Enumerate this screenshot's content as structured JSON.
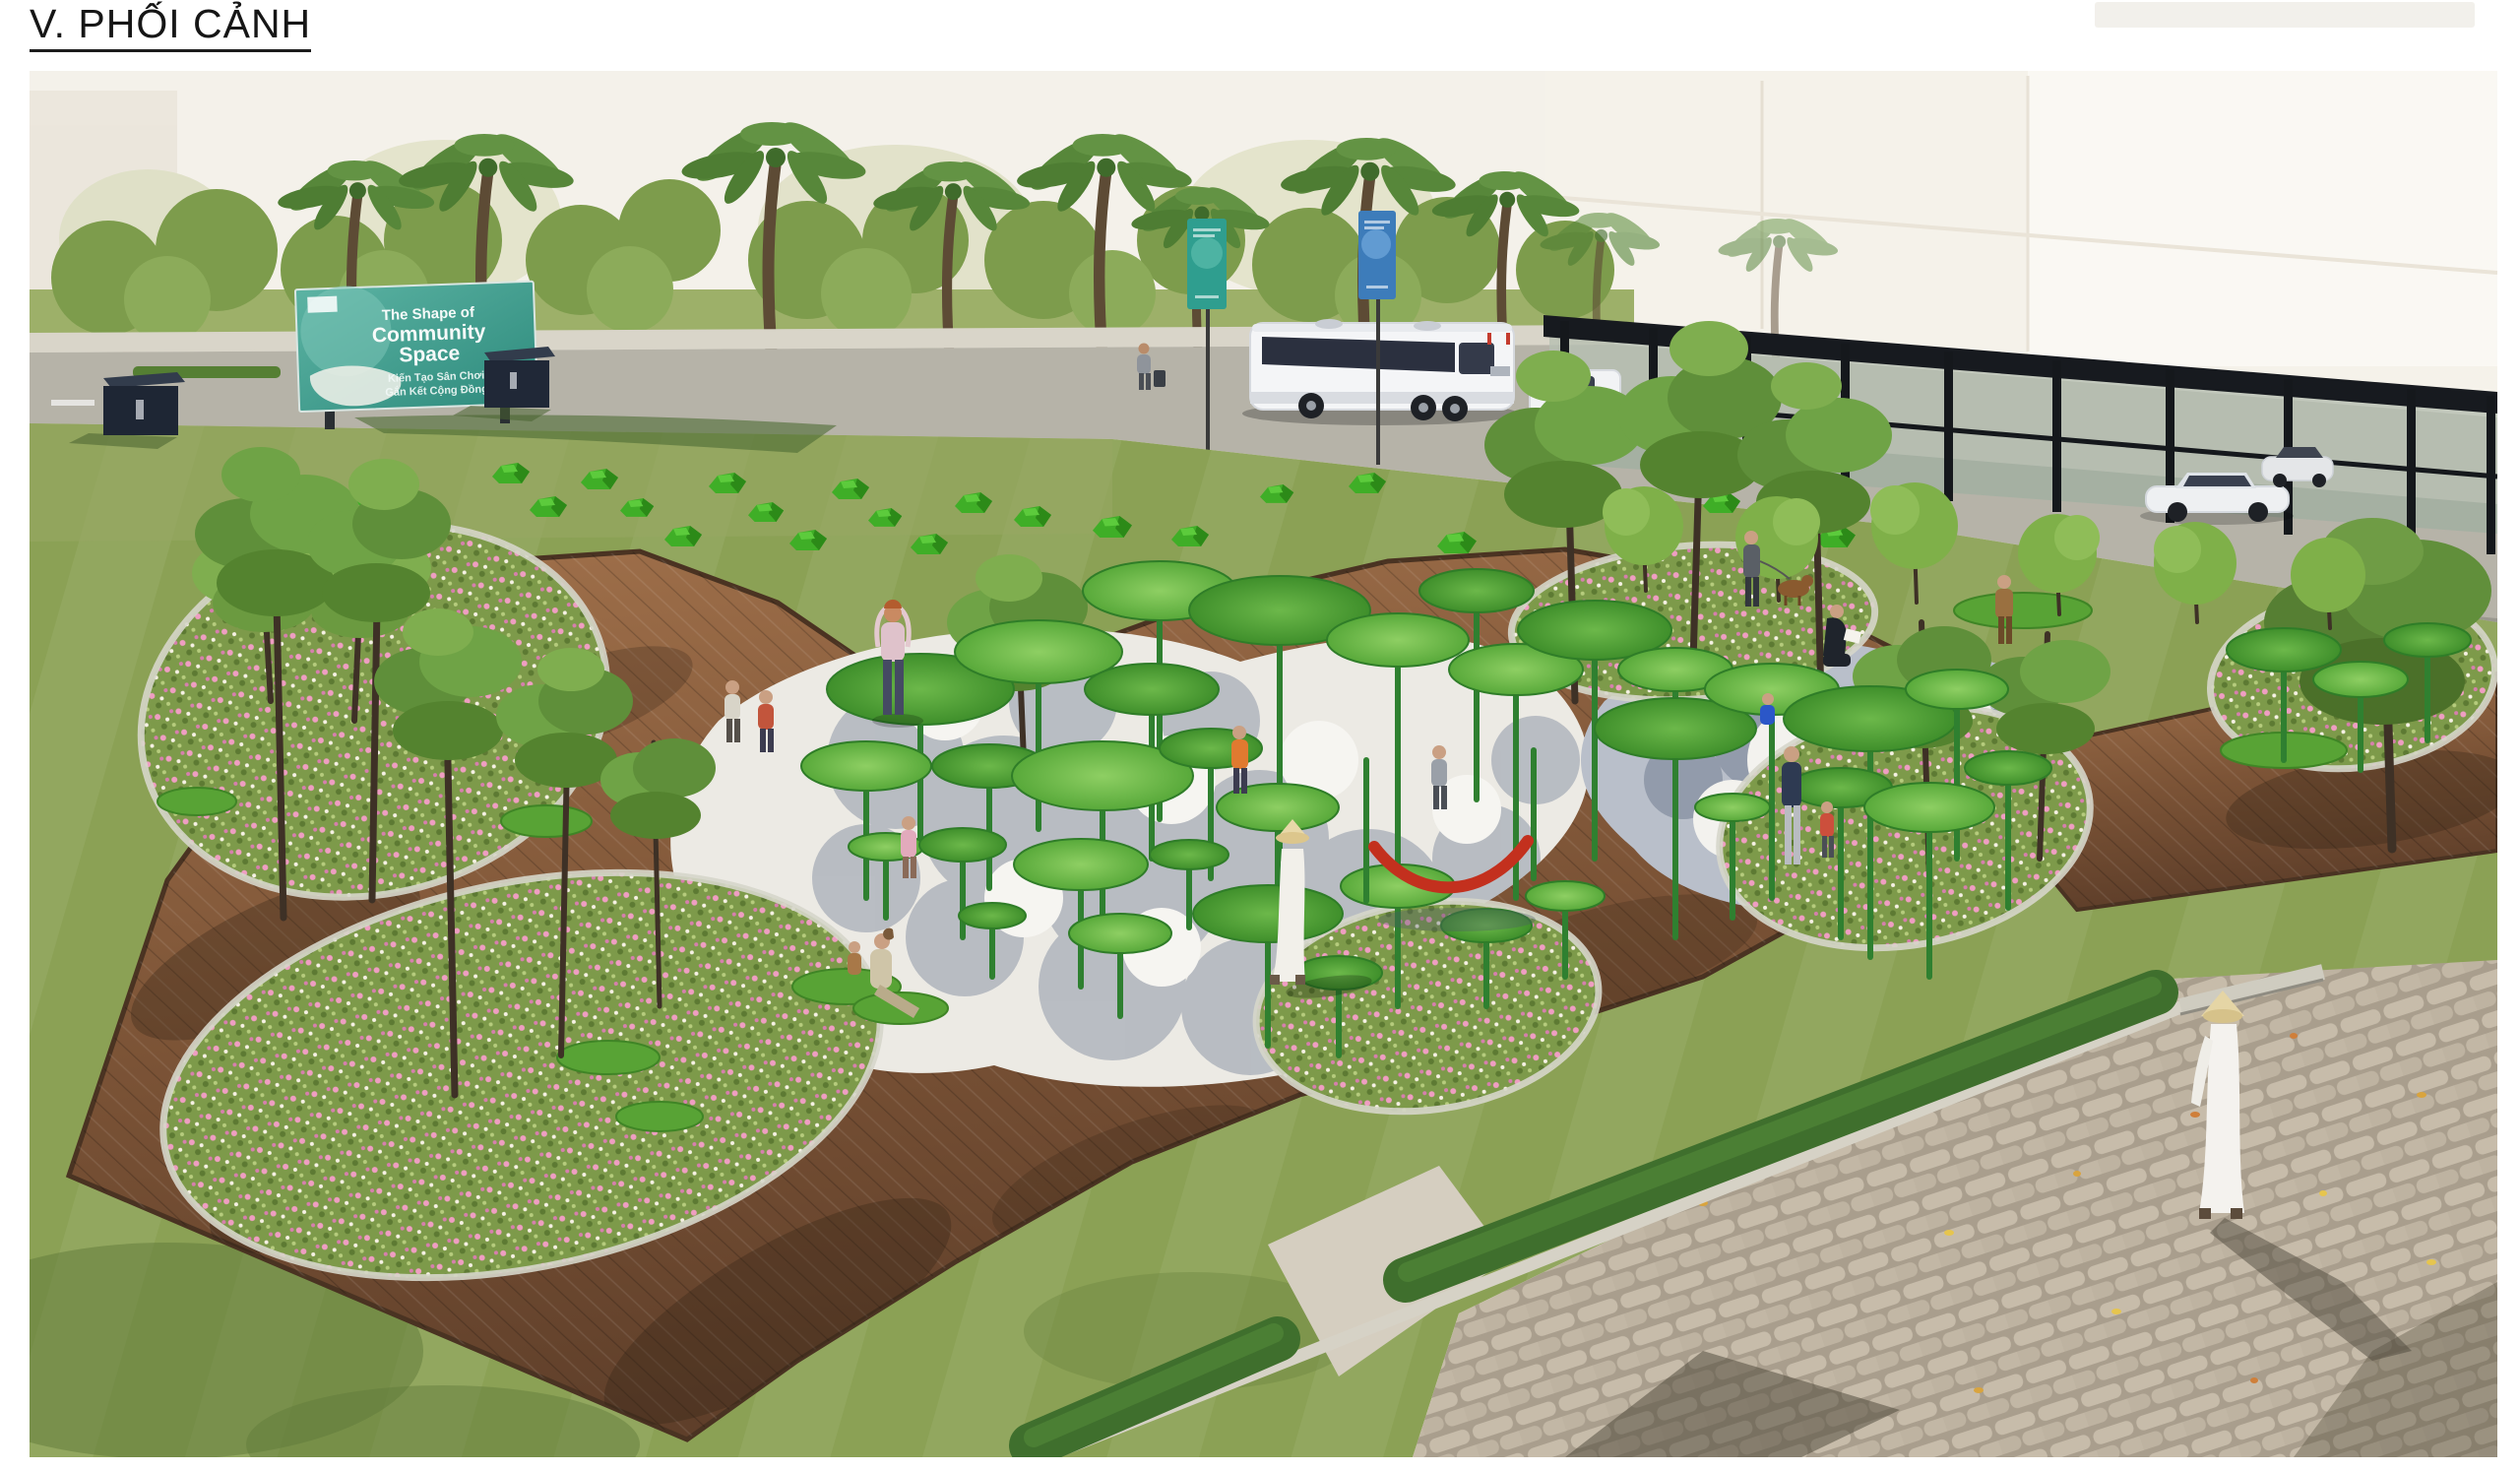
{
  "page": {
    "title": "V. PHỐI CẢNH"
  },
  "render": {
    "description": "Aerial perspective rendering of a community playground park with lotus-leaf canopy structures, wooden deck, flower islands, lawn, road with bus and pergola",
    "billboard": {
      "title_line1": "The Shape of",
      "title_line2": "Community",
      "title_line3": "Space",
      "subtitle_line1": "Kiến Tạo Sân Chơi",
      "subtitle_line2": "Gắn Kết Cộng Đồng",
      "panel_color": "#3f9e8e"
    },
    "colors": {
      "sky_haze": "#f4f1ea",
      "lawn": "#8ba155",
      "deck_wood": "#8a5f3e",
      "canopy_green": "#4f9c33",
      "gravel_light": "#eceae4",
      "gravel_blue": "#9aa2b0",
      "flower_pink": "#e9aec7",
      "hedge_green": "#3f6f2d",
      "paver_tan": "#bfb5a4",
      "hammock_red": "#c3301e",
      "banner_teal": "#2f9e8f",
      "banner_blue": "#3a7ab8",
      "structure_black": "#15181c"
    }
  }
}
